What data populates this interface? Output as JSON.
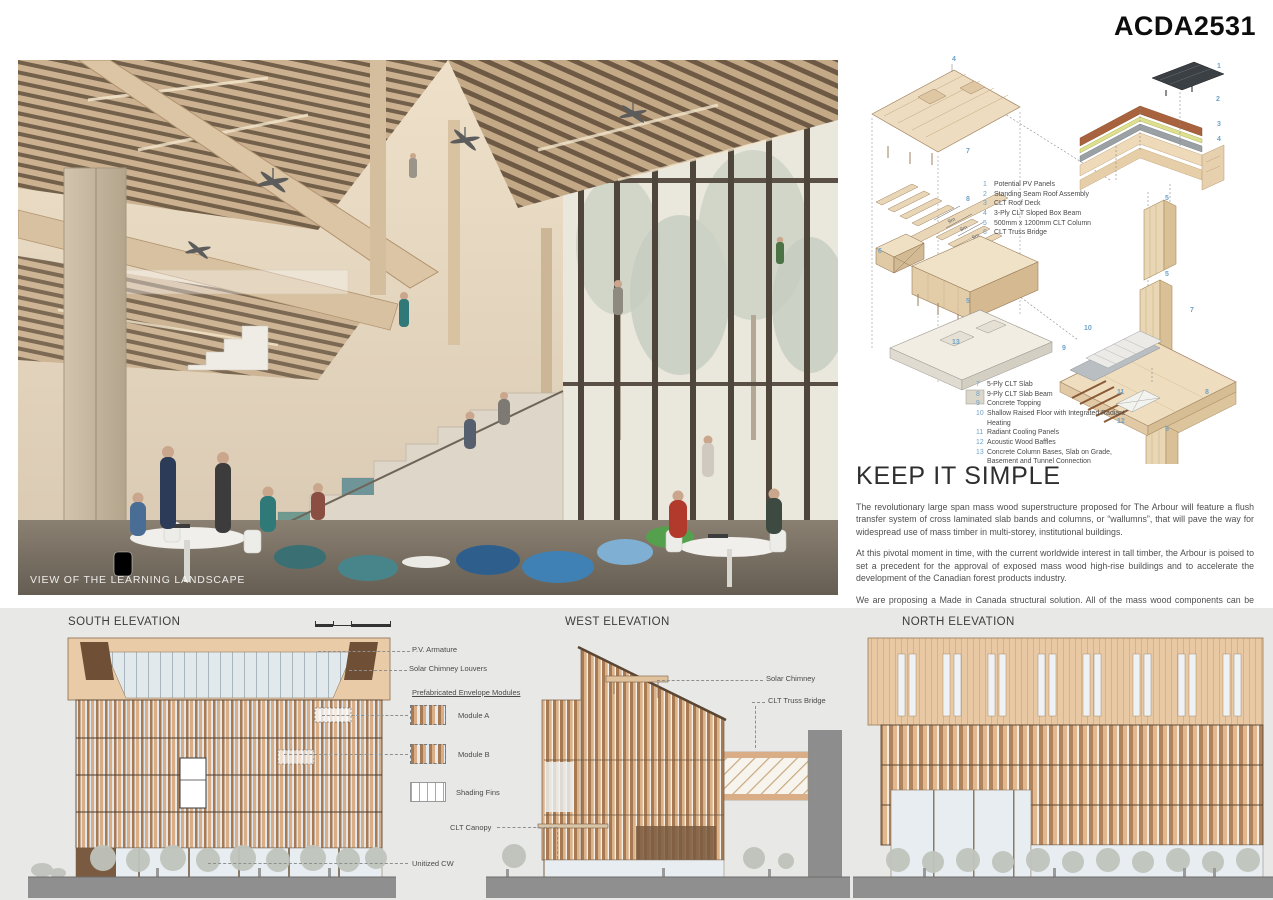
{
  "header": {
    "board_id": "ACDA2531"
  },
  "render": {
    "caption": "VIEW OF THE LEARNING LANDSCAPE"
  },
  "axo": {
    "dim_label": "9m",
    "legend_top": [
      {
        "n": "1",
        "t": "Potential PV Panels"
      },
      {
        "n": "2",
        "t": "Standing Seam Roof Assembly"
      },
      {
        "n": "3",
        "t": "CLT Roof Deck"
      },
      {
        "n": "4",
        "t": "3-Ply CLT Sloped Box Beam"
      },
      {
        "n": "5",
        "t": "500mm x 1200mm CLT Column"
      },
      {
        "n": "6",
        "t": "CLT Truss Bridge"
      }
    ],
    "legend_bottom": [
      {
        "n": "7",
        "t": "5-Ply CLT Slab"
      },
      {
        "n": "8",
        "t": "9-Ply CLT Slab Beam"
      },
      {
        "n": "9",
        "t": "Concrete Topping"
      },
      {
        "n": "10",
        "t": "Shallow Raised Floor with Integrated Radiant Heating"
      },
      {
        "n": "11",
        "t": "Radiant Cooling Panels"
      },
      {
        "n": "12",
        "t": "Acoustic Wood Baffles"
      },
      {
        "n": "13",
        "t": "Concrete Column Bases, Slab on Grade, Basement and Tunnel Connection"
      }
    ],
    "callouts": {
      "stack": [
        "4",
        "7",
        "8",
        "6",
        "5",
        "13"
      ],
      "roof": [
        "1",
        "2",
        "3",
        "4",
        "5"
      ],
      "detail": [
        "5",
        "7",
        "10",
        "9",
        "8",
        "11",
        "12",
        "5"
      ]
    }
  },
  "article": {
    "title": "KEEP IT SIMPLE",
    "paragraphs": [
      "The revolutionary large span mass wood superstructure proposed for The Arbour will feature a flush transfer system of cross laminated slab bands and columns, or “wallumns”, that will pave the way for widespread use of mass timber in multi-storey, institutional buildings.",
      "At this pivotal moment in time, with the current worldwide interest in tall timber, the Arbour is poised to set a precedent for the approval of exposed mass wood high-rise buildings and to accelerate the development of the Canadian forest products industry.",
      "We are proposing a Made in Canada structural solution. All of the mass wood components can be sourced nationally, which will make the design and construction of The Arbour a truly Made in Canada endeavour."
    ]
  },
  "elevations": {
    "south": {
      "title": "SOUTH ELEVATION",
      "labels": {
        "pv": "P.V. Armature",
        "louvers": "Solar Chimney Louvers",
        "modules_heading": "Prefabricated Envelope Modules",
        "module_a": "Module A",
        "module_b": "Module B",
        "shading": "Shading Fins",
        "canopy": "CLT Canopy",
        "cw": "Unitized CW"
      }
    },
    "west": {
      "title": "WEST ELEVATION",
      "labels": {
        "chimney": "Solar Chimney",
        "bridge": "CLT Truss Bridge"
      }
    },
    "north": {
      "title": "NORTH ELEVATION"
    }
  },
  "colors": {
    "callout_blue": "#6fa3c8",
    "facade_tan": "#e8c9a4",
    "stripe_brown": "#a87a54",
    "ground_gray": "#8f8f8f",
    "strip_bg": "#e8e8e6"
  }
}
